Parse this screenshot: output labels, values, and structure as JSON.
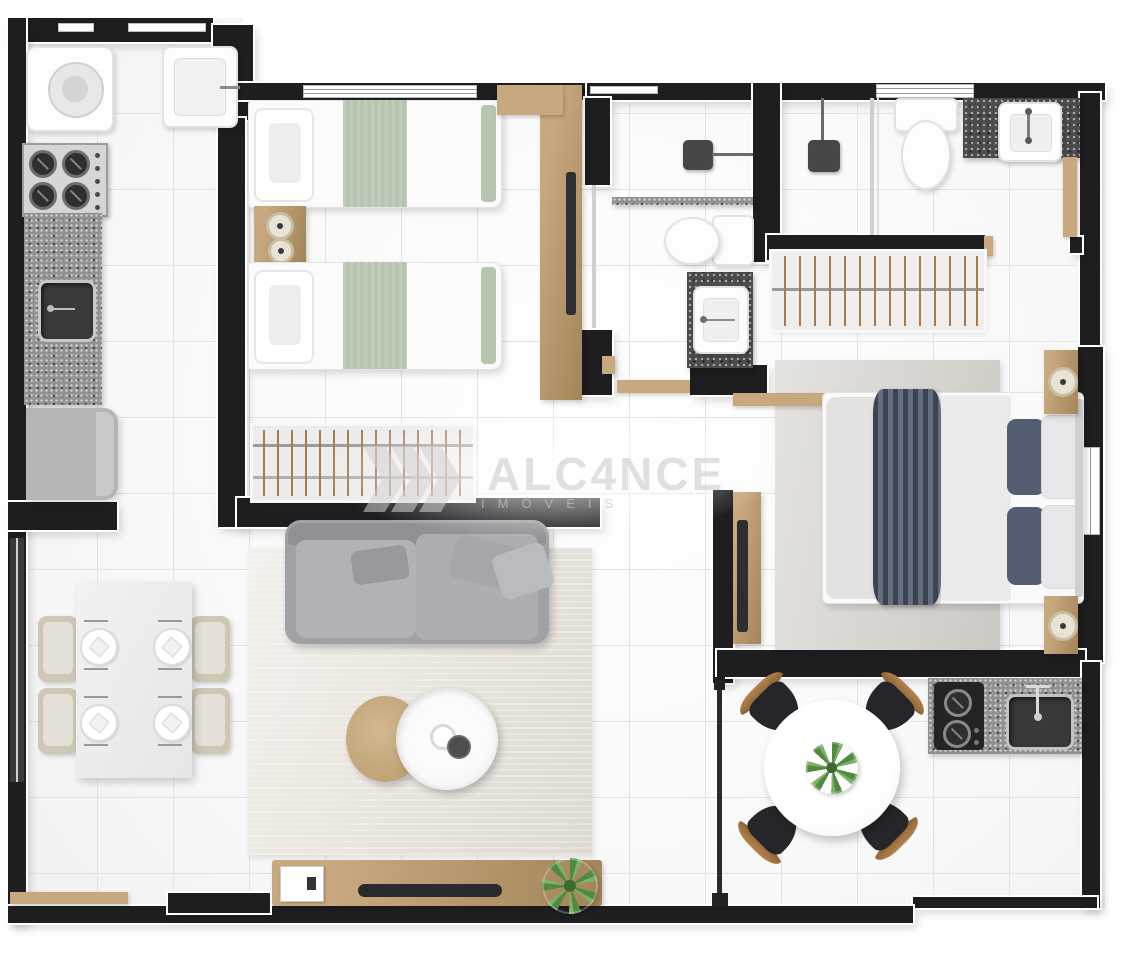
{
  "watermark": {
    "brand": "ALC4NCE",
    "subtitle": "IMÓVEIS",
    "logo": "triple-chevron-right"
  },
  "palette": {
    "wall": "#1e1e20",
    "wall_outline": "#ffffff",
    "floor": "#f7f7f7",
    "grout": "#e3e3e3",
    "wood": "#c8a87e",
    "wood_dark": "#a3855a",
    "granite_dark": "#4b4b4d",
    "granite_gray": "#919193",
    "sofa_gray": "#b0b2b5",
    "rug_living": "#e7e2d9",
    "rug_bedroom": "#d7d4cf",
    "bedding_green": "#b7c4b0",
    "bedding_navy": "#56617560",
    "navy": "#535e72",
    "chair_beige": "#cec7b6",
    "chair_black": "#26262a",
    "plant_green": "#4f8a3f",
    "appliance_gray": "#b5b5b7"
  },
  "floor_plan": {
    "view": "top-down apartment floor plan render",
    "rooms": [
      {
        "id": "laundry",
        "fixtures": [
          "washing-machine",
          "laundry-tank-sink"
        ]
      },
      {
        "id": "kitchen",
        "fixtures": [
          "gas-cooktop-4-burner",
          "granite-countertop",
          "kitchen-sink",
          "refrigerator"
        ]
      },
      {
        "id": "twin-bedroom",
        "fixtures": [
          "single-bed",
          "single-bed",
          "nightstand",
          "clothes-rack",
          "wardrobe-tv-panel"
        ]
      },
      {
        "id": "social-bathroom",
        "fixtures": [
          "shower-head",
          "shower-curb",
          "toilet",
          "vanity-sink"
        ]
      },
      {
        "id": "suite-bathroom",
        "fixtures": [
          "shower-head",
          "glass-partition",
          "toilet",
          "vanity-sink",
          "window"
        ]
      },
      {
        "id": "closet",
        "fixtures": [
          "clothes-rack"
        ]
      },
      {
        "id": "master-bedroom",
        "fixtures": [
          "double-bed",
          "nightstand",
          "nightstand",
          "tv-panel",
          "area-rug",
          "wall-shelf",
          "window"
        ]
      },
      {
        "id": "living-room",
        "fixtures": [
          "sofa",
          "coffee-table-wood",
          "coffee-table-marble",
          "area-rug",
          "tv-sideboard",
          "plant",
          "picture-frame"
        ]
      },
      {
        "id": "dining-area",
        "fixtures": [
          "dining-table",
          "dining-chair",
          "dining-chair",
          "dining-chair",
          "dining-chair",
          "place-setting",
          "place-setting",
          "place-setting",
          "place-setting"
        ]
      },
      {
        "id": "balcony-gourmet",
        "fixtures": [
          "round-dining-table",
          "plant-centerpiece",
          "chair",
          "chair",
          "chair",
          "chair",
          "granite-counter",
          "cooktop-2-burner",
          "counter-sink",
          "glass-railing"
        ]
      }
    ]
  }
}
